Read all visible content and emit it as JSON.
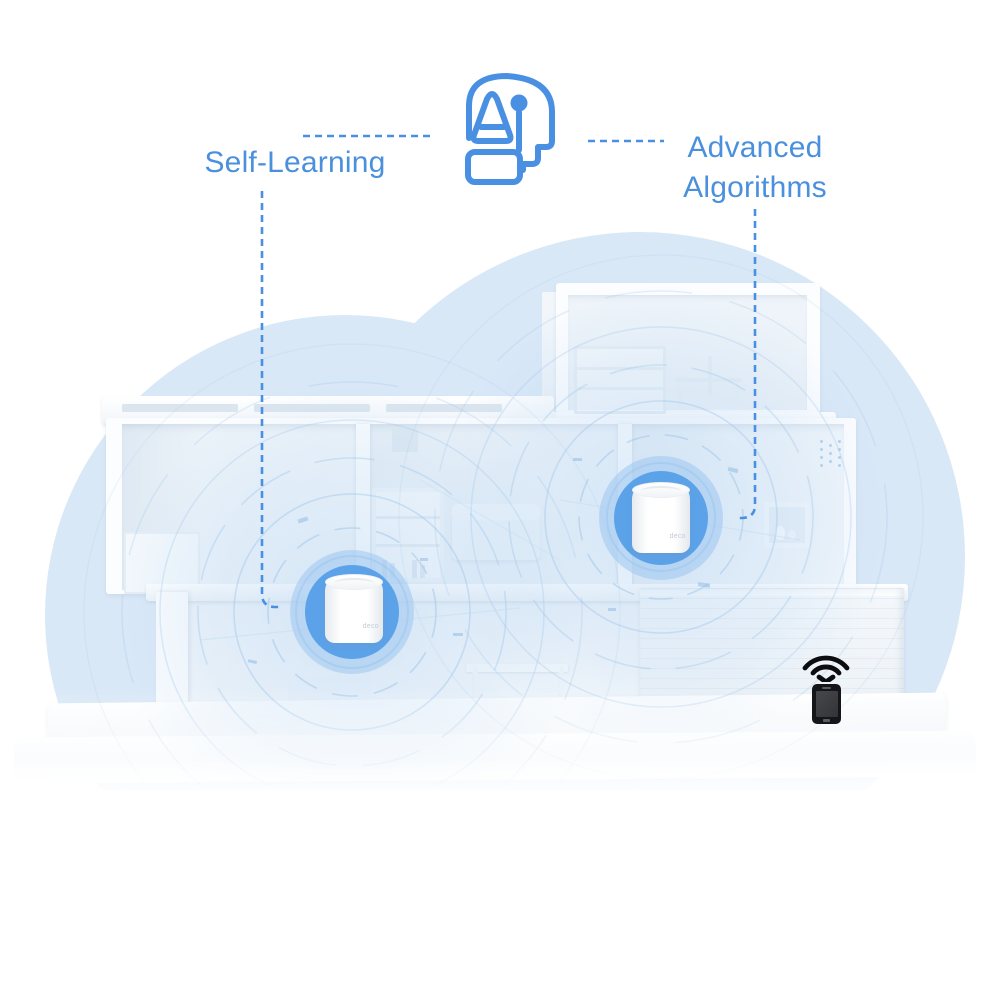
{
  "annotations": {
    "left_label": "Self-Learning",
    "right_label_line1": "Advanced",
    "right_label_line2": "Algorithms"
  },
  "devices": [
    {
      "label": "deco"
    },
    {
      "label": "deco"
    }
  ],
  "icons": {
    "ai_head": "ai-head-icon",
    "wifi_signal": "wifi-signal-icon",
    "smartphone": "smartphone-icon"
  },
  "colors": {
    "accent_blue": "#4a90e2",
    "label_blue": "#4a90dd",
    "halo_blue": "#5ba2e9",
    "halo_ring": "#9cc6f0",
    "cloud_blue": "#d9e8f7",
    "phone_black": "#16161a"
  }
}
